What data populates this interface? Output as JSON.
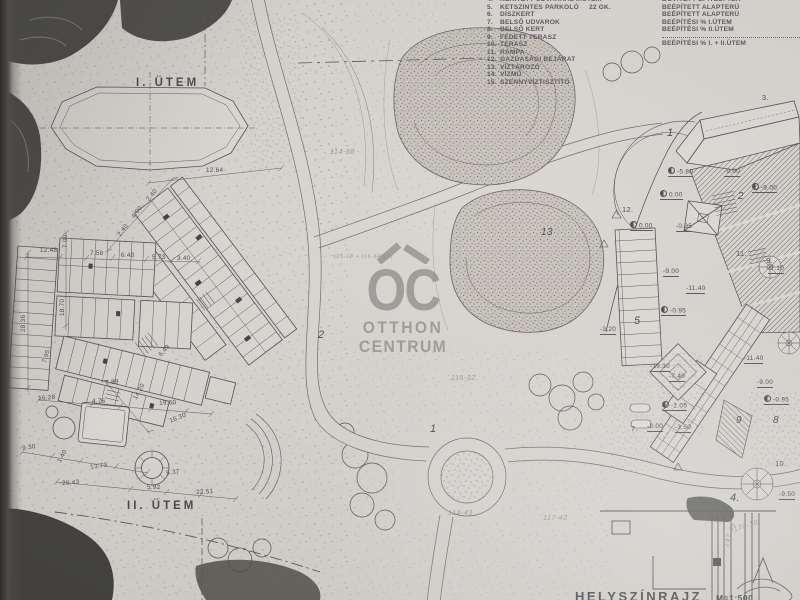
{
  "photo": {
    "paper_color": "#d8d5d0",
    "ink_color": "#4b4b4e",
    "pencil_color": "#8e8c87",
    "watermark_color": "#64625e"
  },
  "legend": {
    "items": [
      {
        "num": "4.",
        "label": "KERÍTETT UDVARRAL II.ÜTEM"
      },
      {
        "num": "5.",
        "label": "KETSZINTES PARKOLÓ",
        "extra": "22 GK."
      },
      {
        "num": "6.",
        "label": "DÍSZKERT"
      },
      {
        "num": "7.",
        "label": "BELSŐ UDVAROK"
      },
      {
        "num": "8.",
        "label": "BELSŐ KERT"
      },
      {
        "num": "9.",
        "label": "FEDETT TERASZ"
      },
      {
        "num": "10.",
        "label": "TERASZ"
      },
      {
        "num": "11.",
        "label": "RÁMPA"
      },
      {
        "num": "12.",
        "label": "GAZDASÁGI BEJÁRAT"
      },
      {
        "num": "13.",
        "label": "VÍZTÁROZÓ"
      },
      {
        "num": "14.",
        "label": "VÍZMŰ"
      },
      {
        "num": "15.",
        "label": "SZENNYVÍZTISZTÍTÓ"
      }
    ],
    "right_items": [
      "BŐVÍTETT ÉPÍTÉSI TER",
      "BEÉPÍTETT ALAPTERÜ",
      "BEÉPÍTETT ALAPTERÜ",
      "BEÉPÍTÉSI % I.ÜTEM",
      "BEÉPÍTÉSI % II.ÜTEM",
      "BEÉPÍTÉSI % I. + II.ÜTEM"
    ]
  },
  "watermark": {
    "monogram": "OC",
    "line1": "OTTHON",
    "line2": "CENTRUM"
  },
  "title_block": {
    "title": "HELYSZÍNRAJZ",
    "scale": "M=1:500"
  },
  "annotations": [
    {
      "t": "I. ÜTEM",
      "x": 136,
      "y": 78,
      "c": "phase",
      "n": "phase-1-label"
    },
    {
      "t": "II. ÜTEM",
      "x": 127,
      "y": 501,
      "c": "phase",
      "n": "phase-2-label"
    },
    {
      "t": "12.64",
      "x": 206,
      "y": 168,
      "c": "dim"
    },
    {
      "t": "2.40",
      "x": 117,
      "y": 234,
      "r": -52,
      "c": "dim"
    },
    {
      "t": "4.00",
      "x": 131,
      "y": 216,
      "r": -52,
      "c": "dim"
    },
    {
      "t": "2.40",
      "x": 146,
      "y": 199,
      "r": -52,
      "c": "dim"
    },
    {
      "t": "12.48",
      "x": 40,
      "y": 248,
      "c": "dim"
    },
    {
      "t": "7.58",
      "x": 90,
      "y": 251,
      "c": "dim"
    },
    {
      "t": "6.48",
      "x": 121,
      "y": 253,
      "c": "dim"
    },
    {
      "t": "5.73",
      "x": 152,
      "y": 255,
      "c": "dim"
    },
    {
      "t": "3.40",
      "x": 177,
      "y": 256,
      "c": "dim"
    },
    {
      "t": "7.00",
      "x": 63,
      "y": 248,
      "r": -90,
      "c": "dim"
    },
    {
      "t": "18.70",
      "x": 60,
      "y": 316,
      "r": -90,
      "c": "dim"
    },
    {
      "t": "28.36",
      "x": 21,
      "y": 332,
      "r": -90,
      "c": "dim"
    },
    {
      "t": "7.95",
      "x": 42,
      "y": 362,
      "r": -72,
      "c": "dim"
    },
    {
      "t": "6.49",
      "x": 158,
      "y": 354,
      "r": -48,
      "c": "dim"
    },
    {
      "t": "16.28",
      "x": 38,
      "y": 396,
      "r": -4,
      "c": "dim"
    },
    {
      "t": "7.88",
      "x": 105,
      "y": 381,
      "r": -8,
      "c": "dim"
    },
    {
      "t": "4.76",
      "x": 92,
      "y": 399,
      "c": "dim"
    },
    {
      "t": "14.20",
      "x": 133,
      "y": 398,
      "r": -62,
      "c": "dim"
    },
    {
      "t": "19.60",
      "x": 159,
      "y": 401,
      "r": -3,
      "c": "dim"
    },
    {
      "t": "16.30",
      "x": 169,
      "y": 419,
      "r": -22,
      "c": "dim"
    },
    {
      "t": "9.30",
      "x": 22,
      "y": 446,
      "r": -8,
      "c": "dim"
    },
    {
      "t": "1.40",
      "x": 57,
      "y": 461,
      "r": -62,
      "c": "dim"
    },
    {
      "t": "13.73",
      "x": 90,
      "y": 465,
      "r": -8,
      "c": "dim"
    },
    {
      "t": "26.43",
      "x": 62,
      "y": 481,
      "r": -4,
      "c": "dim"
    },
    {
      "t": "5.92",
      "x": 147,
      "y": 485,
      "c": "dim"
    },
    {
      "t": "5.37",
      "x": 166,
      "y": 471,
      "r": -8,
      "c": "dim"
    },
    {
      "t": "22.51",
      "x": 196,
      "y": 490,
      "r": -3,
      "c": "dim"
    },
    {
      "t": "1",
      "x": 430,
      "y": 424,
      "c": "lbl",
      "n": "area-1-label"
    },
    {
      "t": "2",
      "x": 318,
      "y": 330,
      "c": "lbl"
    },
    {
      "t": "13",
      "x": 541,
      "y": 228,
      "c": "lbl",
      "s": 10,
      "n": "reservoir-13-label"
    },
    {
      "t": "1",
      "x": 667,
      "y": 128,
      "c": "lbl"
    },
    {
      "t": "3.",
      "x": 762,
      "y": 94,
      "c": "num"
    },
    {
      "t": "12.",
      "x": 622,
      "y": 206,
      "c": "num"
    },
    {
      "t": "2",
      "x": 738,
      "y": 192,
      "c": "lbl",
      "s": 10
    },
    {
      "t": "5",
      "x": 634,
      "y": 316,
      "c": "lbl",
      "s": 11
    },
    {
      "t": "7.",
      "x": 631,
      "y": 425,
      "c": "num"
    },
    {
      "t": "9",
      "x": 736,
      "y": 416,
      "c": "lbl",
      "s": 10
    },
    {
      "t": "8",
      "x": 773,
      "y": 416,
      "c": "lbl",
      "s": 10
    },
    {
      "t": "4.",
      "x": 730,
      "y": 493,
      "c": "lbl",
      "s": 11
    },
    {
      "t": "10.",
      "x": 775,
      "y": 460,
      "c": "num"
    },
    {
      "t": "11.",
      "x": 736,
      "y": 250,
      "c": "num"
    },
    {
      "t": "9.",
      "x": 766,
      "y": 257,
      "c": "num"
    },
    {
      "t": "-5.80",
      "x": 668,
      "y": 167,
      "c": "elev",
      "m": 1
    },
    {
      "t": "-9.00",
      "x": 724,
      "y": 169,
      "c": "elev"
    },
    {
      "t": "0.00",
      "x": 660,
      "y": 190,
      "c": "elev",
      "m": 1
    },
    {
      "t": "-9.00",
      "x": 752,
      "y": 183,
      "c": "elev",
      "m": 1
    },
    {
      "t": "0.00",
      "x": 630,
      "y": 221,
      "c": "elev",
      "m": 1
    },
    {
      "t": "-0.95",
      "x": 676,
      "y": 224,
      "c": "elev"
    },
    {
      "t": "-9.00",
      "x": 663,
      "y": 269,
      "c": "elev"
    },
    {
      "t": "-11.40",
      "x": 686,
      "y": 286,
      "c": "elev"
    },
    {
      "t": "-0.95",
      "x": 661,
      "y": 306,
      "c": "elev",
      "m": 1
    },
    {
      "t": "-3.20",
      "x": 600,
      "y": 327,
      "c": "elev"
    },
    {
      "t": "-19.30",
      "x": 650,
      "y": 364,
      "c": "elev"
    },
    {
      "t": "-7.40",
      "x": 669,
      "y": 374,
      "c": "elev"
    },
    {
      "t": "-11.40",
      "x": 744,
      "y": 356,
      "c": "elev"
    },
    {
      "t": "-9.00",
      "x": 757,
      "y": 380,
      "c": "elev"
    },
    {
      "t": "-0.95",
      "x": 764,
      "y": 395,
      "c": "elev",
      "m": 1
    },
    {
      "t": "-2.05",
      "x": 662,
      "y": 401,
      "c": "elev",
      "m": 1
    },
    {
      "t": "-2.00",
      "x": 647,
      "y": 424,
      "c": "elev"
    },
    {
      "t": "-3.50",
      "x": 675,
      "y": 425,
      "c": "elev"
    },
    {
      "t": "-7.10",
      "x": 768,
      "y": 266,
      "c": "elev"
    },
    {
      "t": "-9.50",
      "x": 779,
      "y": 492,
      "c": "elev"
    },
    {
      "t": "114-88",
      "x": 330,
      "y": 149,
      "c": "pencil",
      "n": "pencil-note"
    },
    {
      "t": "115-18 + (16-64)21(",
      "x": 333,
      "y": 255,
      "s": 5.5,
      "c": "pencil",
      "n": "pencil-note"
    },
    {
      "t": "115-32",
      "x": 451,
      "y": 375,
      "c": "pencil",
      "n": "pencil-note"
    },
    {
      "t": "114-43",
      "x": 448,
      "y": 510,
      "c": "pencil",
      "n": "pencil-note"
    },
    {
      "t": "117-42",
      "x": 543,
      "y": 515,
      "c": "pencil",
      "n": "pencil-note"
    },
    {
      "t": "170-10",
      "x": 733,
      "y": 527,
      "r": -18,
      "c": "pencil",
      "n": "pencil-note"
    },
    {
      "t": "147-45",
      "x": 723,
      "y": 546,
      "r": -72,
      "c": "pencil",
      "n": "pencil-note"
    }
  ]
}
